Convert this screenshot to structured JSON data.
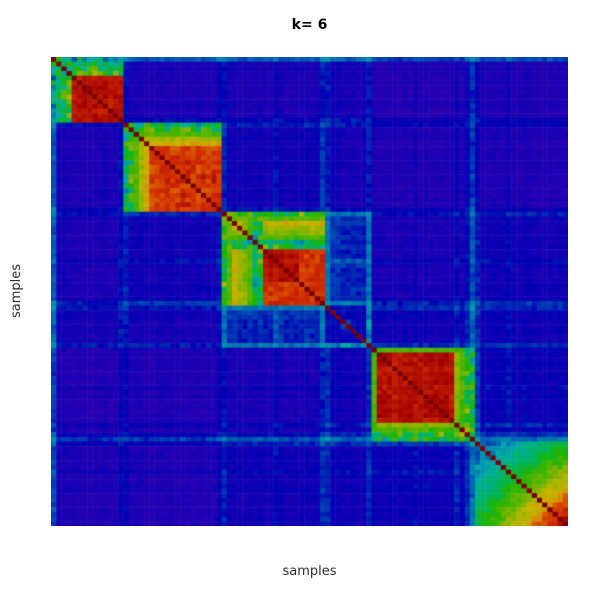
{
  "figure": {
    "background": "#ffffff",
    "title_color": "#000000",
    "label_color": "#303030"
  },
  "chart_data": {
    "type": "heatmap",
    "title": "k= 6",
    "xlabel": "samples",
    "ylabel": "samples",
    "description": "Consensus clustering matrix for k=6; samples ordered so that six high-consensus blocks lie along the diagonal on a low-consensus purple background with blue/cyan streaks.",
    "n_samples": 100,
    "value_range": [
      0,
      1
    ],
    "seed": 1337,
    "colormap": {
      "stops": [
        [
          0.0,
          "#3C00A8"
        ],
        [
          0.1,
          "#1E00B4"
        ],
        [
          0.18,
          "#0000B4"
        ],
        [
          0.28,
          "#0064B4"
        ],
        [
          0.36,
          "#00AAAA"
        ],
        [
          0.46,
          "#00B45A"
        ],
        [
          0.55,
          "#1EB400"
        ],
        [
          0.65,
          "#78B400"
        ],
        [
          0.74,
          "#C8B400"
        ],
        [
          0.82,
          "#DC7800"
        ],
        [
          0.9,
          "#D22D00"
        ],
        [
          1.0,
          "#A00000"
        ]
      ],
      "diagonal": "#780000"
    },
    "clusters": [
      {
        "label": "cluster-1",
        "start": 0,
        "end": 14,
        "mode": "min",
        "core": 0.97,
        "jitter": 0.04,
        "head": [
          0.4,
          0.46,
          0.5,
          0.56
        ]
      },
      {
        "label": "cluster-2",
        "start": 14,
        "end": 33,
        "mode": "min",
        "core": 0.93,
        "jitter": 0.06,
        "head": [
          0.46,
          0.55,
          0.6,
          0.7,
          0.76
        ]
      },
      {
        "label": "cluster-3",
        "start": 33,
        "end": 53,
        "mode": "min",
        "core": 0.72,
        "jitter": 0.26,
        "head": [
          0.56,
          0.62
        ],
        "tail": [
          0.52
        ],
        "subblocks": [
          {
            "from": 41,
            "to": 47,
            "q": 0.96
          },
          {
            "from": 48,
            "to": 52,
            "q": 0.9
          }
        ]
      },
      {
        "label": "cluster-4",
        "start": 53,
        "end": 62,
        "mode": "mul",
        "core": 0.62,
        "jitter": 0.34
      },
      {
        "label": "cluster-5",
        "start": 62,
        "end": 82,
        "mode": "min",
        "core": 0.98,
        "jitter": 0.04,
        "head": [
          0.6
        ],
        "tail": [
          0.66,
          0.6,
          0.55,
          0.48
        ]
      },
      {
        "label": "cluster-6",
        "start": 82,
        "end": 100,
        "mode": "mul",
        "ramp": [
          0.5,
          1.0
        ],
        "jitter": 0.08
      }
    ],
    "pair_base": [
      [
        0.0,
        0.06,
        0.06,
        0.08,
        0.04,
        0.05
      ],
      [
        0.06,
        0.0,
        0.09,
        0.08,
        0.05,
        0.05
      ],
      [
        0.06,
        0.09,
        0.0,
        0.17,
        0.07,
        0.09
      ],
      [
        0.08,
        0.08,
        0.17,
        0.0,
        0.1,
        0.1
      ],
      [
        0.04,
        0.05,
        0.07,
        0.1,
        0.0,
        0.11
      ],
      [
        0.05,
        0.05,
        0.09,
        0.1,
        0.11,
        0.0
      ]
    ],
    "background_affinity_range": [
      0.05,
      0.16
    ],
    "b_overrides": {
      "0": 0.5,
      "13": 0.3,
      "14": 0.3,
      "32": 0.26,
      "33": 0.3,
      "43": 0.24,
      "52": 0.34,
      "53": 0.3,
      "61": 0.3,
      "70": 0.2,
      "78": 0.26,
      "80": 0.28,
      "81": 0.45,
      "82": 0.3,
      "88": 0.22
    },
    "noise_within": 0.07,
    "noise_head": 0.3,
    "noise_between": 0.05
  }
}
